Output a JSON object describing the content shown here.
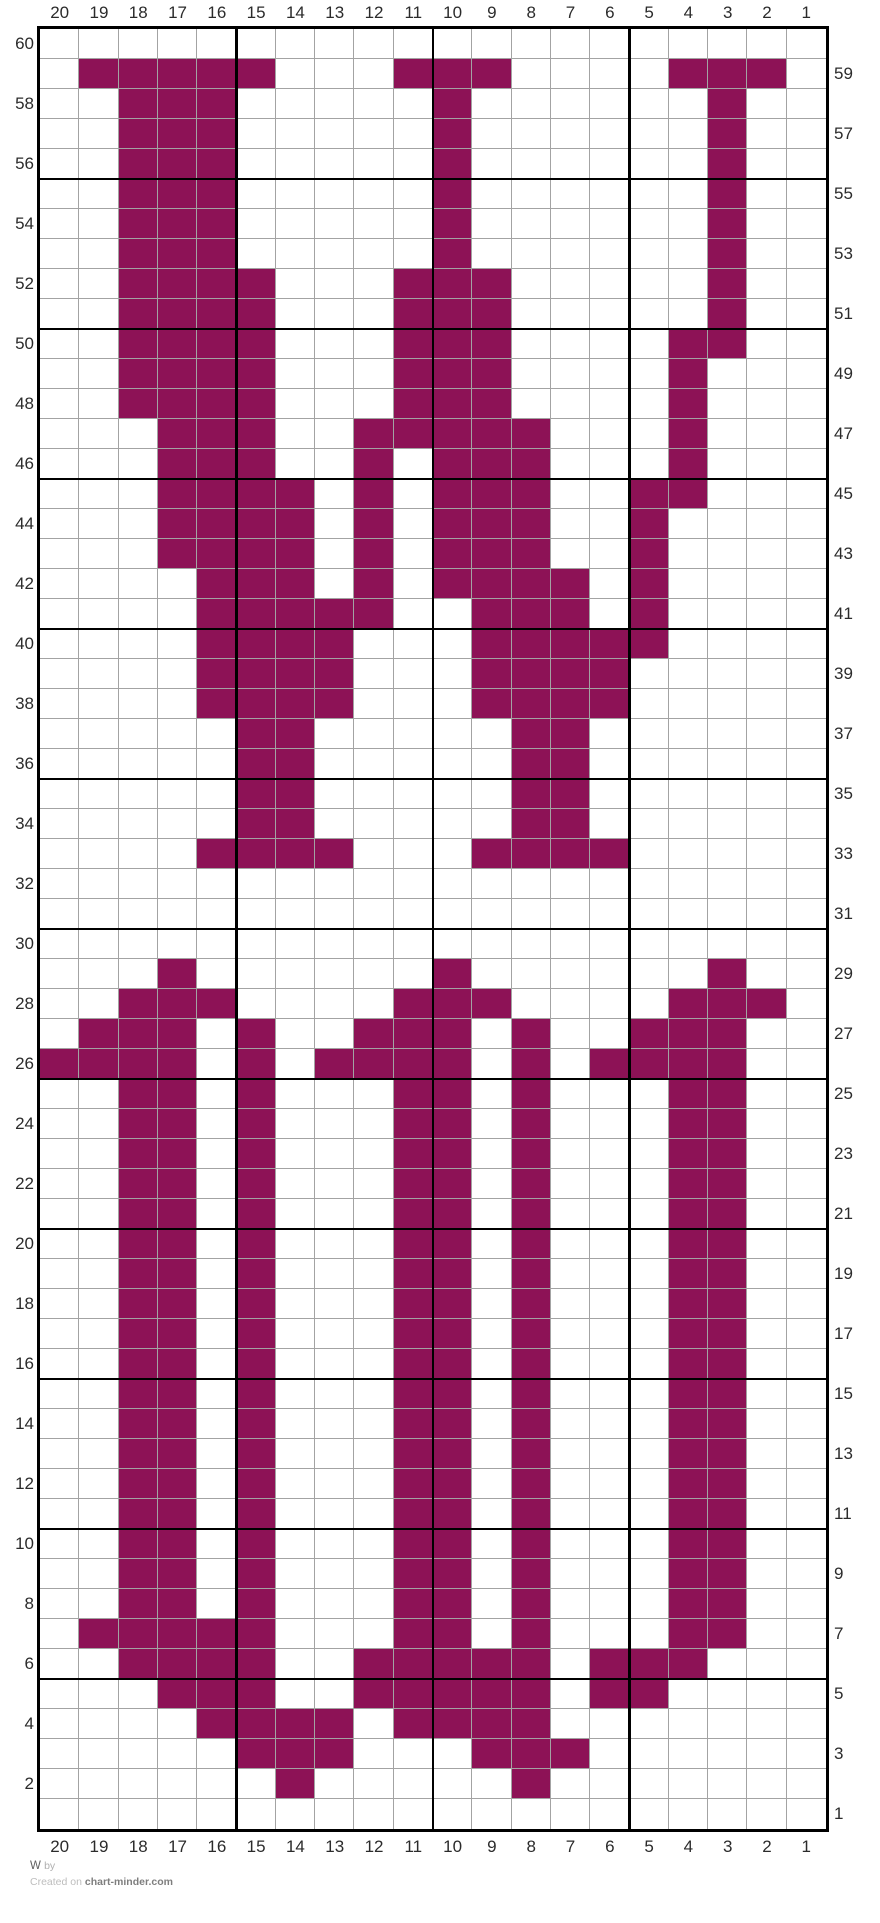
{
  "footer": {
    "title": "W",
    "by_label": "by",
    "credit_prefix": "Created on ",
    "site_link": "chart-minder.com"
  },
  "chart_data": {
    "type": "heatmap",
    "title": "W colorwork knitting chart (20 stitches x 60 rows)",
    "grid": {
      "columns": 20,
      "rows": 60,
      "bold_every": 5
    },
    "column_labels_top": [
      "20",
      "19",
      "18",
      "17",
      "16",
      "15",
      "14",
      "13",
      "12",
      "11",
      "10",
      "9",
      "8",
      "7",
      "6",
      "5",
      "4",
      "3",
      "2",
      "1"
    ],
    "column_labels_bottom": [
      "20",
      "19",
      "18",
      "17",
      "16",
      "15",
      "14",
      "13",
      "12",
      "11",
      "10",
      "9",
      "8",
      "7",
      "6",
      "5",
      "4",
      "3",
      "2",
      "1"
    ],
    "row_labels_left": [
      "60",
      "58",
      "56",
      "54",
      "52",
      "50",
      "48",
      "46",
      "44",
      "42",
      "40",
      "38",
      "36",
      "34",
      "32",
      "30",
      "28",
      "26",
      "24",
      "22",
      "20",
      "18",
      "16",
      "14",
      "12",
      "10",
      "8",
      "6",
      "4",
      "2"
    ],
    "row_labels_right": [
      "59",
      "57",
      "55",
      "53",
      "51",
      "49",
      "47",
      "45",
      "43",
      "41",
      "39",
      "37",
      "35",
      "33",
      "31",
      "29",
      "27",
      "25",
      "23",
      "21",
      "19",
      "17",
      "15",
      "13",
      "11",
      "9",
      "7",
      "5",
      "3",
      "1"
    ],
    "colors": {
      "filled": "#8D1256",
      "empty": "#ffffff",
      "grid_thin": "#a3a3a3",
      "grid_bold": "#000000"
    },
    "filled_cells_by_row": {
      "59": [
        19,
        18,
        17,
        16,
        15,
        11,
        10,
        9,
        4,
        3,
        2
      ],
      "58": [
        18,
        17,
        16,
        10,
        3
      ],
      "57": [
        18,
        17,
        16,
        10,
        3
      ],
      "56": [
        18,
        17,
        16,
        10,
        3
      ],
      "55": [
        18,
        17,
        16,
        10,
        3
      ],
      "54": [
        18,
        17,
        16,
        10,
        3
      ],
      "53": [
        18,
        17,
        16,
        10,
        3
      ],
      "52": [
        18,
        17,
        16,
        15,
        11,
        10,
        9,
        3
      ],
      "51": [
        18,
        17,
        16,
        15,
        11,
        10,
        9,
        3
      ],
      "50": [
        18,
        17,
        16,
        15,
        11,
        10,
        9,
        4,
        3
      ],
      "49": [
        18,
        17,
        16,
        15,
        11,
        10,
        9,
        4
      ],
      "48": [
        18,
        17,
        16,
        15,
        11,
        10,
        9,
        4
      ],
      "47": [
        17,
        16,
        15,
        12,
        11,
        10,
        9,
        8,
        4
      ],
      "46": [
        17,
        16,
        15,
        12,
        10,
        9,
        8,
        4
      ],
      "45": [
        17,
        16,
        15,
        14,
        12,
        10,
        9,
        8,
        5,
        4
      ],
      "44": [
        17,
        16,
        15,
        14,
        12,
        10,
        9,
        8,
        5
      ],
      "43": [
        17,
        16,
        15,
        14,
        12,
        10,
        9,
        8,
        5
      ],
      "42": [
        16,
        15,
        14,
        12,
        10,
        9,
        8,
        7,
        5
      ],
      "41": [
        16,
        15,
        14,
        13,
        12,
        9,
        8,
        7,
        5
      ],
      "40": [
        16,
        15,
        14,
        13,
        9,
        8,
        7,
        6,
        5
      ],
      "39": [
        16,
        15,
        14,
        13,
        9,
        8,
        7,
        6
      ],
      "38": [
        16,
        15,
        14,
        13,
        9,
        8,
        7,
        6
      ],
      "37": [
        15,
        14,
        8,
        7
      ],
      "36": [
        15,
        14,
        8,
        7
      ],
      "35": [
        15,
        14,
        8,
        7
      ],
      "34": [
        15,
        14,
        8,
        7
      ],
      "33": [
        16,
        15,
        14,
        13,
        9,
        8,
        7,
        6
      ],
      "29": [
        17,
        10,
        3
      ],
      "28": [
        18,
        17,
        16,
        11,
        10,
        9,
        4,
        3,
        2
      ],
      "27": [
        19,
        18,
        17,
        15,
        12,
        11,
        10,
        8,
        5,
        4,
        3
      ],
      "26": [
        20,
        19,
        18,
        17,
        15,
        13,
        12,
        11,
        10,
        8,
        6,
        5,
        4,
        3
      ],
      "25": [
        18,
        17,
        15,
        11,
        10,
        8,
        4,
        3
      ],
      "24": [
        18,
        17,
        15,
        11,
        10,
        8,
        4,
        3
      ],
      "23": [
        18,
        17,
        15,
        11,
        10,
        8,
        4,
        3
      ],
      "22": [
        18,
        17,
        15,
        11,
        10,
        8,
        4,
        3
      ],
      "21": [
        18,
        17,
        15,
        11,
        10,
        8,
        4,
        3
      ],
      "20": [
        18,
        17,
        15,
        11,
        10,
        8,
        4,
        3
      ],
      "19": [
        18,
        17,
        15,
        11,
        10,
        8,
        4,
        3
      ],
      "18": [
        18,
        17,
        15,
        11,
        10,
        8,
        4,
        3
      ],
      "17": [
        18,
        17,
        15,
        11,
        10,
        8,
        4,
        3
      ],
      "16": [
        18,
        17,
        15,
        11,
        10,
        8,
        4,
        3
      ],
      "15": [
        18,
        17,
        15,
        11,
        10,
        8,
        4,
        3
      ],
      "14": [
        18,
        17,
        15,
        11,
        10,
        8,
        4,
        3
      ],
      "13": [
        18,
        17,
        15,
        11,
        10,
        8,
        4,
        3
      ],
      "12": [
        18,
        17,
        15,
        11,
        10,
        8,
        4,
        3
      ],
      "11": [
        18,
        17,
        15,
        11,
        10,
        8,
        4,
        3
      ],
      "10": [
        18,
        17,
        15,
        11,
        10,
        8,
        4,
        3
      ],
      "9": [
        18,
        17,
        15,
        11,
        10,
        8,
        4,
        3
      ],
      "8": [
        18,
        17,
        15,
        11,
        10,
        8,
        4,
        3
      ],
      "7": [
        19,
        18,
        17,
        16,
        15,
        11,
        10,
        8,
        4,
        3
      ],
      "6": [
        18,
        17,
        16,
        15,
        12,
        11,
        10,
        9,
        8,
        6,
        5,
        4
      ],
      "5": [
        17,
        16,
        15,
        12,
        11,
        10,
        9,
        8,
        6,
        5
      ],
      "4": [
        16,
        15,
        14,
        13,
        11,
        10,
        9,
        8
      ],
      "3": [
        15,
        14,
        13,
        9,
        8,
        7
      ],
      "2": [
        14,
        8
      ],
      "1": []
    }
  }
}
